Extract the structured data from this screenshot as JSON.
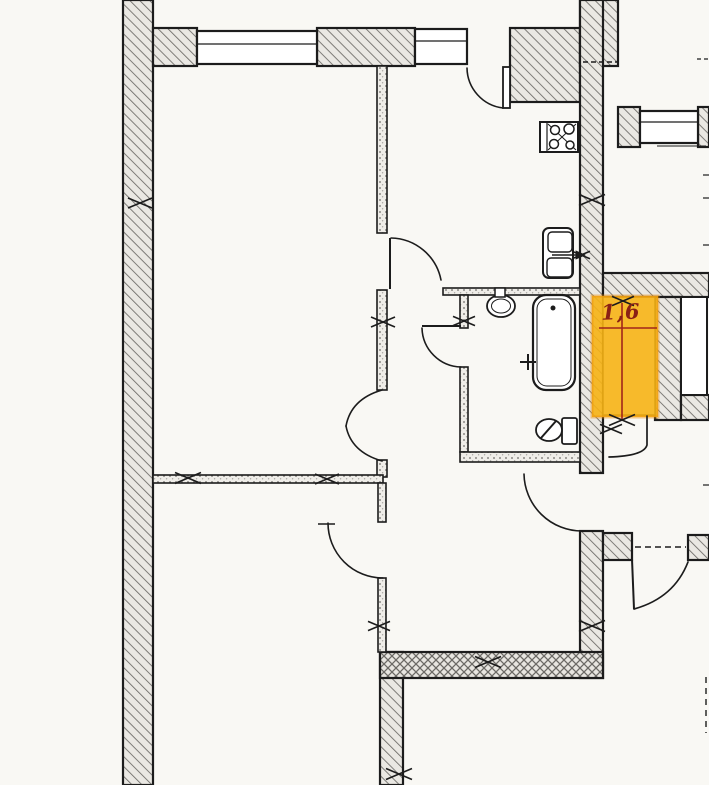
{
  "meta": {
    "type": "apartment-floor-plan",
    "sheet": "scanned blueprint fragment"
  },
  "highlight": {
    "label": "1,6",
    "meaning": "storage-closet-area-sq-m",
    "fill": "#f6b214",
    "edge": "#ee8d06",
    "dim_color": "#a1251a"
  },
  "palette": {
    "ink": "#1c1c1c",
    "paper": "#f9f8f4",
    "room": "#ffffff",
    "wall_fill": "#eae8e3",
    "hatch_line": "#6b6965",
    "dim_red": "#a1251a"
  },
  "geometry": {
    "shapes": [
      {
        "n": "left-exterior-wall",
        "t": "rect",
        "x": 123,
        "y": 0,
        "w": 30,
        "h": 785,
        "f": "hatch",
        "s": 2.2
      },
      {
        "n": "top-wall-segment-a",
        "t": "rect",
        "x": 153,
        "y": 28,
        "w": 44,
        "h": 38,
        "f": "hatch",
        "s": 2.2
      },
      {
        "n": "top-wall-segment-b",
        "t": "rect",
        "x": 317,
        "y": 28,
        "w": 98,
        "h": 38,
        "f": "hatch",
        "s": 2.2
      },
      {
        "n": "kitchen-top-wall-block",
        "t": "rect",
        "x": 510,
        "y": 28,
        "w": 70,
        "h": 74,
        "f": "hatch",
        "s": 2.2
      },
      {
        "n": "main-wall-top-cap",
        "t": "rect",
        "x": 580,
        "y": 0,
        "w": 38,
        "h": 66,
        "f": "hatch",
        "s": 2.2
      },
      {
        "n": "main-vertical-wall-upper",
        "t": "rect",
        "x": 580,
        "y": 0,
        "w": 23,
        "h": 473,
        "f": "hatch",
        "s": 2.2
      },
      {
        "n": "main-vertical-wall-lower",
        "t": "rect",
        "x": 580,
        "y": 531,
        "w": 23,
        "h": 147,
        "f": "hatch",
        "s": 2.2
      },
      {
        "n": "right-window-wall-a",
        "t": "rect",
        "x": 618,
        "y": 107,
        "w": 22,
        "h": 40,
        "f": "hatch",
        "s": 2.2
      },
      {
        "n": "right-window-wall-b",
        "t": "rect",
        "x": 698,
        "y": 107,
        "w": 11,
        "h": 40,
        "f": "hatch",
        "s": 2.2
      },
      {
        "n": "storage-wall-top-band",
        "t": "rect",
        "x": 603,
        "y": 273,
        "w": 106,
        "h": 24,
        "f": "hatch",
        "s": 2.2
      },
      {
        "n": "storage-wall-mid-pier",
        "t": "rect",
        "x": 655,
        "y": 297,
        "w": 26,
        "h": 123,
        "f": "hatch",
        "s": 2.2
      },
      {
        "n": "storage-wall-bottom-band",
        "t": "rect",
        "x": 681,
        "y": 395,
        "w": 28,
        "h": 25,
        "f": "hatch",
        "s": 2.2
      },
      {
        "n": "entry-wall-left-block",
        "t": "rect",
        "x": 603,
        "y": 533,
        "w": 29,
        "h": 27,
        "f": "hatch",
        "s": 2.2
      },
      {
        "n": "entry-wall-right-block",
        "t": "rect",
        "x": 688,
        "y": 535,
        "w": 21,
        "h": 25,
        "f": "hatch",
        "s": 2.2
      },
      {
        "n": "bottom-left-vertical-wall",
        "t": "rect",
        "x": 380,
        "y": 652,
        "w": 23,
        "h": 133,
        "f": "hatch",
        "s": 2.2
      },
      {
        "n": "bottom-thick-wall",
        "t": "rect",
        "x": 380,
        "y": 652,
        "w": 223,
        "h": 26,
        "f": "cross",
        "s": 2.2
      },
      {
        "n": "partition-left-upper",
        "t": "rect",
        "x": 377,
        "y": 66,
        "w": 10,
        "h": 167,
        "f": "speck",
        "s": 1.6
      },
      {
        "n": "partition-left-mid",
        "t": "rect",
        "x": 377,
        "y": 290,
        "w": 10,
        "h": 100,
        "f": "speck",
        "s": 1.6
      },
      {
        "n": "partition-left-stub",
        "t": "rect",
        "x": 377,
        "y": 460,
        "w": 10,
        "h": 17,
        "f": "speck",
        "s": 1.6
      },
      {
        "n": "living-bottom-partition",
        "t": "rect",
        "x": 153,
        "y": 475,
        "w": 230,
        "h": 8,
        "f": "speck",
        "s": 1.6
      },
      {
        "n": "lower-left-partition-a",
        "t": "rect",
        "x": 378,
        "y": 483,
        "w": 8,
        "h": 39,
        "f": "speck",
        "s": 1.6
      },
      {
        "n": "lower-left-partition-b",
        "t": "rect",
        "x": 378,
        "y": 578,
        "w": 8,
        "h": 74,
        "f": "speck",
        "s": 1.6
      },
      {
        "n": "bathroom-top-partition",
        "t": "rect",
        "x": 443,
        "y": 288,
        "w": 137,
        "h": 7,
        "f": "speck",
        "s": 1.6
      },
      {
        "n": "bathroom-left-partition-a",
        "t": "rect",
        "x": 460,
        "y": 295,
        "w": 8,
        "h": 33,
        "f": "speck",
        "s": 1.6
      },
      {
        "n": "bathroom-left-partition-b",
        "t": "rect",
        "x": 460,
        "y": 367,
        "w": 8,
        "h": 85,
        "f": "speck",
        "s": 1.6
      },
      {
        "n": "bathroom-bottom-partition",
        "t": "rect",
        "x": 460,
        "y": 452,
        "w": 120,
        "h": 10,
        "f": "speck",
        "s": 1.6
      },
      {
        "n": "storage-closet-niche",
        "t": "rect",
        "x": 603,
        "y": 297,
        "w": 52,
        "h": 118,
        "f": "white",
        "s": 1.5
      },
      {
        "n": "shaft-niche",
        "t": "rect",
        "x": 681,
        "y": 297,
        "w": 26,
        "h": 98,
        "f": "white",
        "s": 2
      },
      {
        "n": "window-living",
        "t": "rect",
        "x": 197,
        "y": 31,
        "w": 120,
        "h": 33,
        "f": "white",
        "s": 2.2
      },
      {
        "n": "window-living-mullion",
        "t": "line",
        "x1": 197,
        "y1": 44,
        "x2": 317,
        "y2": 44,
        "s": 1.2
      },
      {
        "n": "window-kitchen",
        "t": "rect",
        "x": 415,
        "y": 29,
        "w": 52,
        "h": 35,
        "f": "white",
        "s": 2.2
      },
      {
        "n": "window-kitchen-mullion",
        "t": "line",
        "x1": 415,
        "y1": 41,
        "x2": 467,
        "y2": 41,
        "s": 1.2
      },
      {
        "n": "window-right-room",
        "t": "rect",
        "x": 640,
        "y": 111,
        "w": 58,
        "h": 32,
        "f": "white",
        "s": 2.2
      },
      {
        "n": "window-right-mullion",
        "t": "line",
        "x1": 640,
        "y1": 122,
        "x2": 698,
        "y2": 122,
        "s": 1.2
      },
      {
        "n": "windowsill-right",
        "t": "line",
        "x1": 657,
        "y1": 146,
        "x2": 706,
        "y2": 146,
        "s": 1
      },
      {
        "n": "storage-highlight",
        "t": "rect",
        "x": 592,
        "y": 296,
        "w": 66,
        "h": 121,
        "f": "hl",
        "s": 3,
        "c": "edge"
      },
      {
        "n": "dim-line-horizontal",
        "t": "line",
        "x1": 599,
        "y1": 328,
        "x2": 657,
        "y2": 328,
        "s": 1.6,
        "c": "red"
      },
      {
        "n": "dim-line-vertical",
        "t": "line",
        "x1": 622,
        "y1": 303,
        "x2": 622,
        "y2": 419,
        "s": 1.6,
        "c": "red"
      },
      {
        "n": "balcony-door-leaf",
        "t": "rect",
        "x": 503,
        "y": 67,
        "w": 7,
        "h": 41,
        "f": "white",
        "s": 1.8
      },
      {
        "n": "balcony-door-arc",
        "t": "path",
        "d": "M 467,68 A 41 41 0 0 0 503,108",
        "s": 1.6,
        "f": "none"
      },
      {
        "n": "kitchen-door-leaf",
        "t": "line",
        "x1": 390,
        "y1": 238,
        "x2": 390,
        "y2": 289,
        "s": 2
      },
      {
        "n": "kitchen-door-arc",
        "t": "path",
        "d": "M 391,238 A 52 52 0 0 1 441,280",
        "s": 1.6,
        "f": "none"
      },
      {
        "n": "bathroom-door-leaf",
        "t": "line",
        "x1": 422,
        "y1": 326,
        "x2": 461,
        "y2": 326,
        "s": 2
      },
      {
        "n": "bathroom-door-arc",
        "t": "path",
        "d": "M 422,328 A 40 40 0 0 0 461,367",
        "s": 1.6,
        "f": "none"
      },
      {
        "n": "living-double-door-arc-top",
        "t": "path",
        "d": "M 382,390 Q 351,399 346,426",
        "s": 1.6,
        "f": "none"
      },
      {
        "n": "living-double-door-arc-bottom",
        "t": "path",
        "d": "M 382,461 Q 351,452 346,426",
        "s": 1.6,
        "f": "none"
      },
      {
        "n": "hallway-door-arc",
        "t": "path",
        "d": "M 524,474 A 58 58 0 0 0 582,531",
        "s": 1.6,
        "f": "none"
      },
      {
        "n": "lower-room-door-arc",
        "t": "path",
        "d": "M 328,523 A 55 55 0 0 0 383,578",
        "s": 1.6,
        "f": "none"
      },
      {
        "n": "lower-room-door-tick",
        "t": "line",
        "x1": 318,
        "y1": 524,
        "x2": 335,
        "y2": 524,
        "s": 1.4
      },
      {
        "n": "closet-door",
        "t": "path",
        "d": "M 647,416 L 647,445 Q 644,456 609,457",
        "s": 1.7,
        "f": "none"
      },
      {
        "n": "entry-door-leaf",
        "t": "line",
        "x1": 632,
        "y1": 559,
        "x2": 634,
        "y2": 609,
        "s": 2
      },
      {
        "n": "entry-door-arc",
        "t": "path",
        "d": "M 634,609 Q 674,598 688,562",
        "s": 1.7,
        "f": "none"
      },
      {
        "n": "stove",
        "t": "rect",
        "x": 540,
        "y": 122,
        "w": 38,
        "h": 30,
        "f": "white",
        "s": 2
      },
      {
        "n": "stove-panel-line",
        "t": "line",
        "x1": 547,
        "y1": 122,
        "x2": 547,
        "y2": 152,
        "s": 1.2
      },
      {
        "n": "stove-cross-a",
        "t": "line",
        "x1": 548,
        "y1": 124,
        "x2": 576,
        "y2": 150,
        "s": 1
      },
      {
        "n": "stove-cross-b",
        "t": "line",
        "x1": 548,
        "y1": 150,
        "x2": 576,
        "y2": 124,
        "s": 1
      },
      {
        "n": "stove-burner-1",
        "t": "circle",
        "cx": 555,
        "cy": 130,
        "r": 4.5,
        "f": "white",
        "s": 1.5
      },
      {
        "n": "stove-burner-2",
        "t": "circle",
        "cx": 569,
        "cy": 129,
        "r": 5,
        "f": "white",
        "s": 1.5
      },
      {
        "n": "stove-burner-3",
        "t": "circle",
        "cx": 554,
        "cy": 144,
        "r": 4.5,
        "f": "white",
        "s": 1.5
      },
      {
        "n": "stove-burner-4",
        "t": "circle",
        "cx": 570,
        "cy": 145,
        "r": 4,
        "f": "white",
        "s": 1.5
      },
      {
        "n": "kitchen-sink-unit",
        "t": "rect",
        "x": 543,
        "y": 228,
        "w": 30,
        "h": 50,
        "rx": 6,
        "f": "white",
        "s": 2
      },
      {
        "n": "kitchen-sink-top-basin",
        "t": "rect",
        "x": 548,
        "y": 232,
        "w": 24,
        "h": 20,
        "rx": 4,
        "f": "none",
        "s": 1.4
      },
      {
        "n": "kitchen-sink-bottom-basin",
        "t": "rect",
        "x": 547,
        "y": 258,
        "w": 25,
        "h": 19,
        "rx": 4,
        "f": "none",
        "s": 1.4
      },
      {
        "n": "kitchen-sink-drain-line",
        "t": "line",
        "x1": 552,
        "y1": 255,
        "x2": 584,
        "y2": 255,
        "s": 1.5
      },
      {
        "n": "kitchen-sink-drain-arrow",
        "t": "path",
        "d": "M 585,255 L 576,251 L 576,259 Z",
        "s": 0.8,
        "f": "ink"
      },
      {
        "n": "kitchen-sink-mark",
        "t": "cross",
        "cx": 581,
        "cy": 255,
        "l": 9
      },
      {
        "n": "washbasin",
        "t": "ellipse",
        "cx": 501,
        "cy": 306,
        "rx": 14,
        "ry": 11,
        "f": "white",
        "s": 1.8
      },
      {
        "n": "washbasin-inner",
        "t": "ellipse",
        "cx": 501,
        "cy": 306,
        "rx": 9.5,
        "ry": 7,
        "f": "none",
        "s": 1
      },
      {
        "n": "washbasin-tap",
        "t": "rect",
        "x": 495,
        "y": 288,
        "w": 10,
        "h": 9,
        "f": "white",
        "s": 1.5
      },
      {
        "n": "bathtub",
        "t": "rect",
        "x": 533,
        "y": 295,
        "w": 42,
        "h": 95,
        "rx": 13,
        "f": "white",
        "s": 2.2
      },
      {
        "n": "bathtub-inner",
        "t": "rect",
        "x": 537,
        "y": 299,
        "w": 34,
        "h": 87,
        "rx": 10,
        "f": "none",
        "s": 1
      },
      {
        "n": "bathtub-drain",
        "t": "circle",
        "cx": 553,
        "cy": 308,
        "r": 2.5,
        "f": "ink",
        "s": 0
      },
      {
        "n": "bathtub-tap-h",
        "t": "line",
        "x1": 520,
        "y1": 362,
        "x2": 536,
        "y2": 362,
        "s": 2
      },
      {
        "n": "bathtub-tap-v",
        "t": "line",
        "x1": 528,
        "y1": 354,
        "x2": 528,
        "y2": 370,
        "s": 2
      },
      {
        "n": "toilet-tank",
        "t": "rect",
        "x": 562,
        "y": 418,
        "w": 15,
        "h": 26,
        "rx": 2,
        "f": "white",
        "s": 1.8
      },
      {
        "n": "toilet-bowl",
        "t": "ellipse",
        "cx": 549,
        "cy": 430,
        "rx": 13,
        "ry": 11,
        "f": "white",
        "s": 1.8
      },
      {
        "n": "toilet-seat-line",
        "t": "line",
        "x1": 541,
        "y1": 438,
        "x2": 556,
        "y2": 421,
        "s": 2
      },
      {
        "n": "survey-mark-1",
        "t": "cross",
        "cx": 140,
        "cy": 203,
        "l": 12
      },
      {
        "n": "survey-mark-2",
        "t": "cross",
        "cx": 383,
        "cy": 322,
        "l": 12
      },
      {
        "n": "survey-mark-3",
        "t": "cross",
        "cx": 188,
        "cy": 478,
        "l": 13
      },
      {
        "n": "survey-mark-4",
        "t": "cross",
        "cx": 327,
        "cy": 479,
        "l": 12
      },
      {
        "n": "survey-mark-5",
        "t": "cross",
        "cx": 464,
        "cy": 321,
        "l": 11
      },
      {
        "n": "survey-mark-6",
        "t": "cross",
        "cx": 592,
        "cy": 200,
        "l": 13
      },
      {
        "n": "survey-mark-7",
        "t": "cross",
        "cx": 623,
        "cy": 301,
        "l": 11
      },
      {
        "n": "survey-mark-8",
        "t": "cross",
        "cx": 622,
        "cy": 420,
        "l": 13
      },
      {
        "n": "survey-mark-9",
        "t": "cross",
        "cx": 611,
        "cy": 429,
        "l": 11
      },
      {
        "n": "survey-mark-10",
        "t": "cross",
        "cx": 592,
        "cy": 626,
        "l": 13
      },
      {
        "n": "survey-mark-11",
        "t": "cross",
        "cx": 488,
        "cy": 662,
        "l": 13
      },
      {
        "n": "survey-mark-12",
        "t": "cross",
        "cx": 379,
        "cy": 626,
        "l": 11
      },
      {
        "n": "survey-mark-13",
        "t": "cross",
        "cx": 399,
        "cy": 774,
        "l": 13
      },
      {
        "n": "lintel-dash",
        "t": "line",
        "x1": 583,
        "y1": 62,
        "x2": 617,
        "y2": 62,
        "s": 1.4,
        "dash": "5,3"
      },
      {
        "n": "entry-opening-dash",
        "t": "line",
        "x1": 635,
        "y1": 547,
        "x2": 686,
        "y2": 547,
        "s": 1.4,
        "dash": "6,4"
      },
      {
        "n": "edge-dash-top",
        "t": "line",
        "x1": 697,
        "y1": 59,
        "x2": 709,
        "y2": 59,
        "s": 1.2,
        "dash": "4,3"
      },
      {
        "n": "edge-tick-1",
        "t": "line",
        "x1": 703,
        "y1": 175,
        "x2": 709,
        "y2": 175,
        "s": 1.2
      },
      {
        "n": "edge-tick-2",
        "t": "line",
        "x1": 703,
        "y1": 198,
        "x2": 709,
        "y2": 198,
        "s": 1.2
      },
      {
        "n": "edge-tick-3",
        "t": "line",
        "x1": 703,
        "y1": 245,
        "x2": 709,
        "y2": 245,
        "s": 1.2
      },
      {
        "n": "edge-tick-4",
        "t": "line",
        "x1": 703,
        "y1": 485,
        "x2": 709,
        "y2": 485,
        "s": 1.2
      },
      {
        "n": "edge-dash-bottom",
        "t": "line",
        "x1": 706,
        "y1": 677,
        "x2": 706,
        "y2": 733,
        "s": 1.4,
        "dash": "6,5"
      }
    ]
  }
}
